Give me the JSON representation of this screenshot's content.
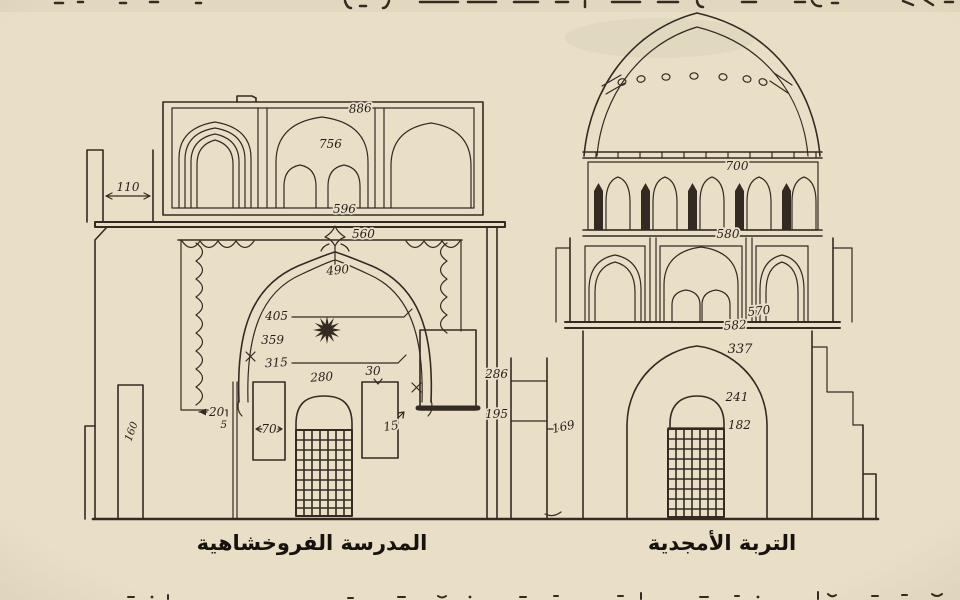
{
  "drawing": {
    "left_building": {
      "label": "المدرسة الفروخشاهية",
      "dims": {
        "frieze_top": "886",
        "frieze_arch": "756",
        "frieze_base": "596",
        "wing_width": "110",
        "portal_frame": "560",
        "arch_crown": "490",
        "level_405": "405",
        "level_359": "359",
        "level_315": "315",
        "door_arch": "280",
        "niche_width_30": "30",
        "niche_width_70": "70",
        "niche_width_15": "15",
        "recess_width_20": "20",
        "pilaster_width_5": "5",
        "base_height_160": "160"
      }
    },
    "party_wall": {
      "height_286": "286",
      "height_195": "195",
      "height_169": "169"
    },
    "right_building": {
      "label": "التربة الأمجدية",
      "dims": {
        "drum_top_700": "700",
        "drum_base_580": "580",
        "level_570": "570",
        "cornice_582": "582",
        "arch_337": "337",
        "window_arch_241": "241",
        "window_top_182": "182"
      }
    },
    "colors": {
      "paper": "#e9dfc7",
      "ink": "#332b22",
      "label_ink": "#16120d"
    }
  }
}
